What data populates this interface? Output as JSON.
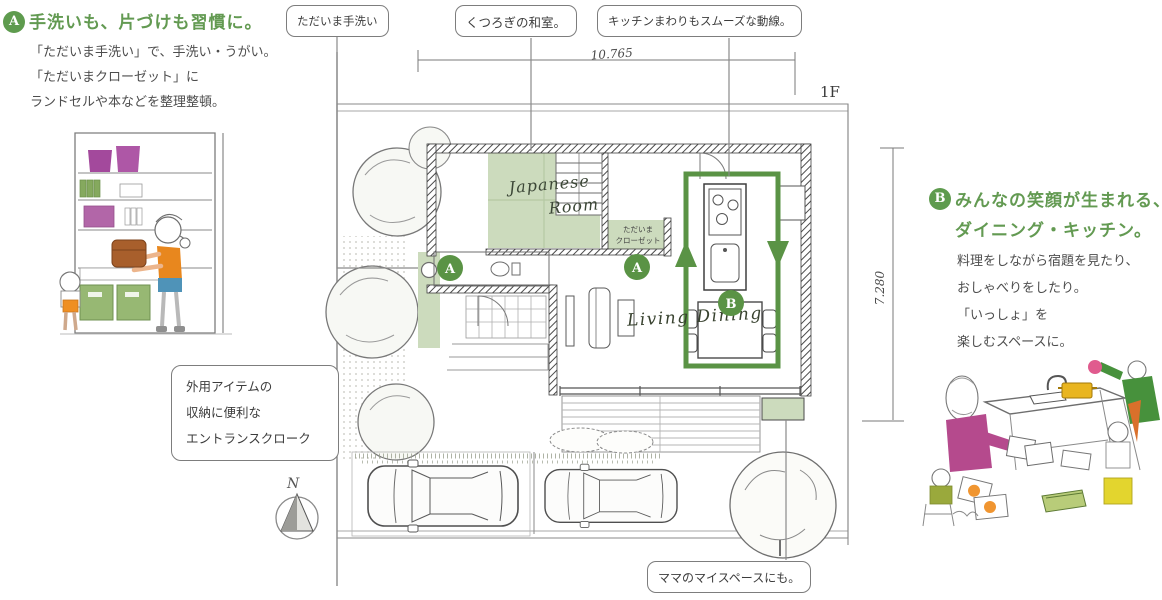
{
  "colors": {
    "accent_green": "#5e9b4e",
    "loop_green": "#5a9345",
    "room_fill_green": "#ccdbbd",
    "body_text": "#4d4d4d",
    "callout_border": "#7d7d7d",
    "sketch_line": "#6e6e6e"
  },
  "section_a": {
    "badge": "A",
    "title": "手洗いも、片づけも習慣に。",
    "body_lines": [
      "「ただいま手洗い」で、手洗い・うがい。",
      "「ただいまクローゼット」に",
      "ランドセルや本などを整理整頓。"
    ]
  },
  "section_b": {
    "badge": "B",
    "title_lines": [
      "みんなの笑顔が生まれる、",
      "ダイニング・キッチン。"
    ],
    "body_lines": [
      "料理をしながら宿題を見たり、",
      "おしゃべりをしたり。",
      "「いっしょ」を",
      "楽しむスペースに。"
    ]
  },
  "callouts": {
    "tadaima_tearai": "ただいま手洗い",
    "washitsu": "くつろぎの和室。",
    "kitchen_flow": "キッチンまわりもスムーズな動線。",
    "entrance_cloak_lines": [
      "外用アイテムの",
      "収納に便利な",
      "エントランスクローク"
    ],
    "mama_space": "ママのマイスペースにも。"
  },
  "plan": {
    "floor_label": "1F",
    "width_dim": "10.765",
    "height_dim": "7.280",
    "japanese_room_line1": "Japanese",
    "japanese_room_line2": "Room",
    "living_dining": "Living Dining",
    "closet_line1": "ただいま",
    "closet_line2": "クローゼット",
    "marker_a1": "A",
    "marker_a2": "A",
    "marker_b": "B",
    "compass_label": "N"
  }
}
